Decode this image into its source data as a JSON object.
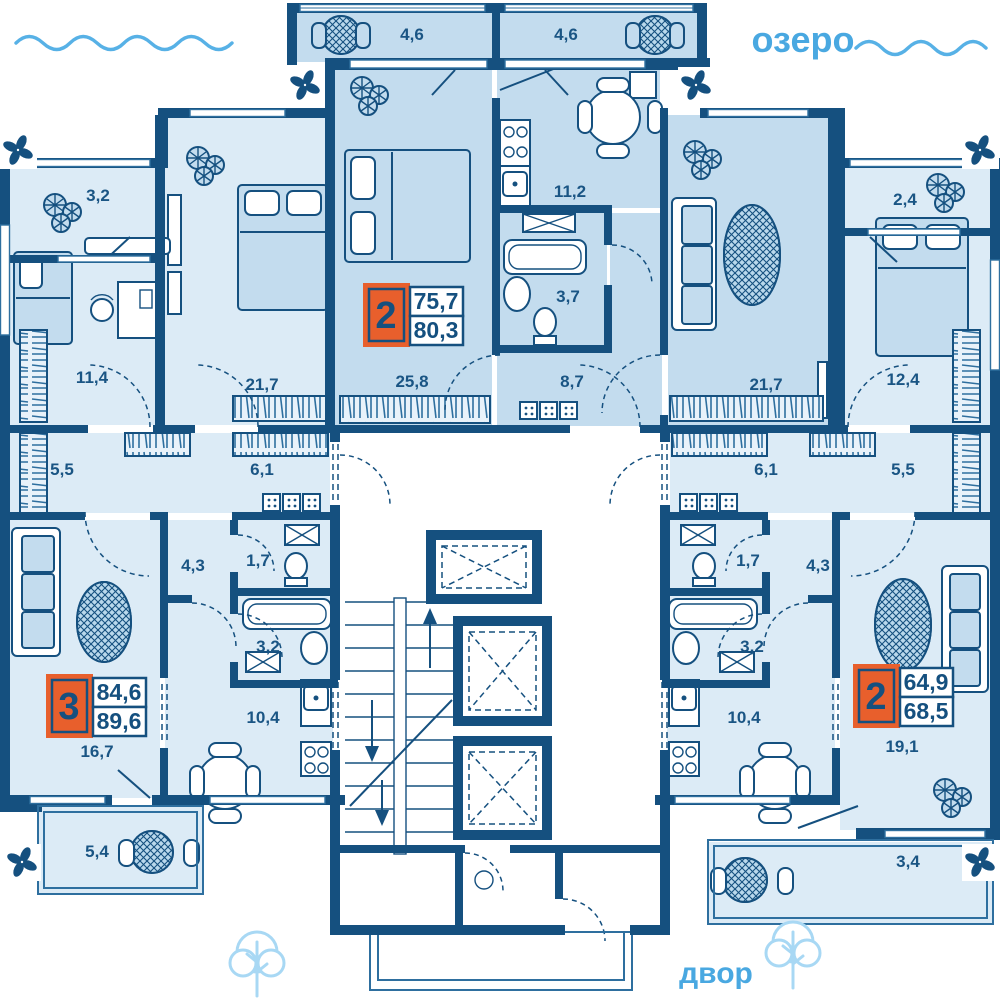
{
  "environment": {
    "lake_label": "озеро",
    "yard_label": "двор"
  },
  "apartments": [
    {
      "name": "left-3-room",
      "rooms_count": "3",
      "area_living": "84,6",
      "area_total": "89,6"
    },
    {
      "name": "center-2-room",
      "rooms_count": "2",
      "area_living": "75,7",
      "area_total": "80,3"
    },
    {
      "name": "right-2-room",
      "rooms_count": "2",
      "area_living": "64,9",
      "area_total": "68,5"
    }
  ],
  "rooms": [
    {
      "room": "balcony-top-left",
      "area": "4,6"
    },
    {
      "room": "balcony-top-right",
      "area": "4,6"
    },
    {
      "room": "balcony-upper-left-wing",
      "area": "3,2"
    },
    {
      "room": "bedroom-left-wing",
      "area": "11,4"
    },
    {
      "room": "bedroom-left",
      "area": "21,7"
    },
    {
      "room": "bedroom-center",
      "area": "25,8"
    },
    {
      "room": "kitchen-center",
      "area": "11,2"
    },
    {
      "room": "bathroom-center",
      "area": "3,7"
    },
    {
      "room": "hallway-center",
      "area": "8,7"
    },
    {
      "room": "living-room-center",
      "area": "21,7"
    },
    {
      "room": "balcony-upper-right-wing",
      "area": "2,4"
    },
    {
      "room": "bedroom-right-wing",
      "area": "12,4"
    },
    {
      "room": "corridor-left-outer",
      "area": "5,5"
    },
    {
      "room": "corridor-left",
      "area": "6,1"
    },
    {
      "room": "corridor-right",
      "area": "6,1"
    },
    {
      "room": "corridor-right-outer",
      "area": "5,5"
    },
    {
      "room": "hall-left",
      "area": "4,3"
    },
    {
      "room": "wc-left",
      "area": "1,7"
    },
    {
      "room": "bathroom-left",
      "area": "3,2"
    },
    {
      "room": "kitchen-left",
      "area": "10,4"
    },
    {
      "room": "living-room-left",
      "area": "16,7"
    },
    {
      "room": "balcony-bottom-left",
      "area": "5,4"
    },
    {
      "room": "wc-right",
      "area": "1,7"
    },
    {
      "room": "hall-right",
      "area": "4,3"
    },
    {
      "room": "bathroom-right",
      "area": "3,2"
    },
    {
      "room": "kitchen-right",
      "area": "10,4"
    },
    {
      "room": "living-room-right",
      "area": "19,1"
    },
    {
      "room": "balcony-bottom-right",
      "area": "3,4"
    }
  ],
  "colors": {
    "wall": "#15507f",
    "accent": "#e85f2c",
    "water": "#49a8e1",
    "room": "#dcebf6",
    "highlight": "#c3dcee"
  }
}
